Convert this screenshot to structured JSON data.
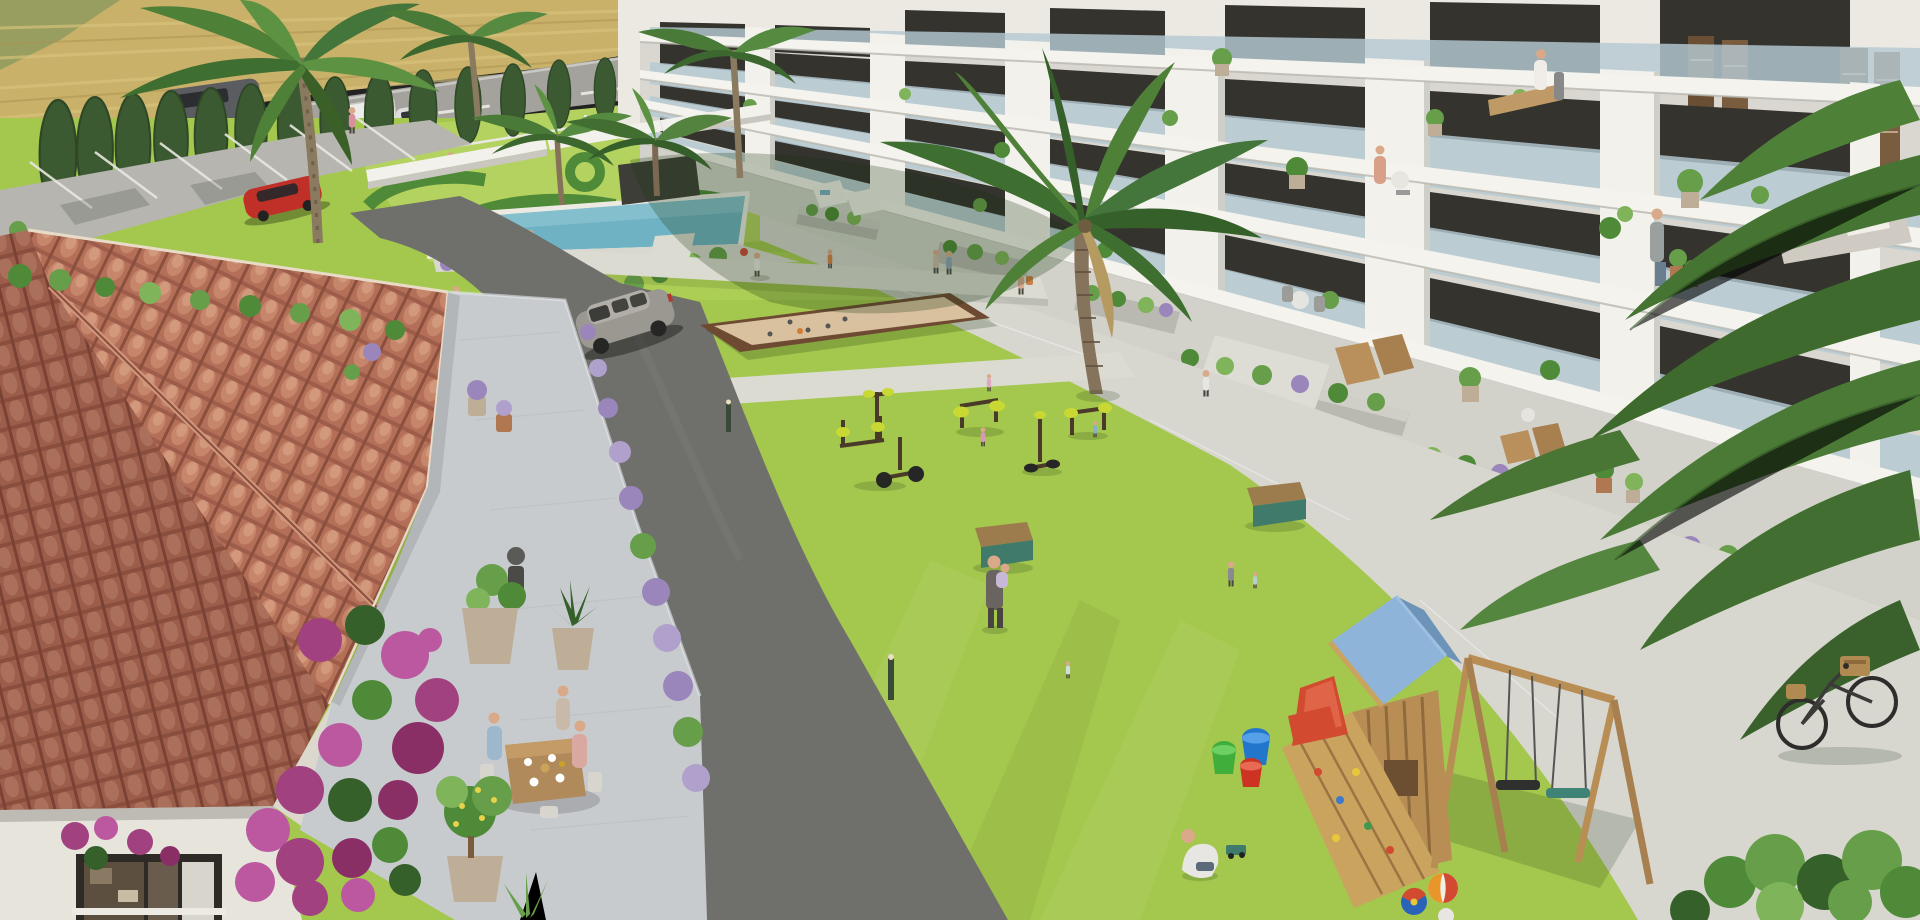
{
  "scene": {
    "title": "Aerial 3D rendering of a Mediterranean residential complex with communal garden courtyard",
    "description": "Daytime high-angle architectural visualization: a modern white apartment block with glass balconies runs diagonally across the upper right; a terracotta tile-roofed clubhouse sits lower left with bougainvillea and an outdoor dining terrace; between them lie lawns with a swimming pool, hedge parterre, petanque court, outdoor gym, children's playground with swing set, paths, an asphalt drive with an SUV, a perimeter road with van and delivery truck beside a wheat field and cypress hedge, and a bicycle parked by ground-floor terraces.",
    "view": "high-angle aerial",
    "style": "photorealistic render",
    "time_of_day": "midday sun from upper left"
  },
  "palette": {
    "wheat": "#c9b169",
    "road": "#a3a29d",
    "parking": "#b6b5b0",
    "lawn": "#a4c74d",
    "lawn_bright": "#b4d25f",
    "hedge": "#4f8a38",
    "asphalt": "#6f6f6b",
    "path": "#d7d6cf",
    "terrace": "#d2d1ca",
    "facade": "#ebe9e2",
    "slab": "#f4f3ee",
    "glass": "#b6c9d3",
    "window": "#34332e",
    "roof_tile": "#b46f58",
    "pool": "#6fb2c4",
    "sand": "#d9c09f",
    "play_roof": "#8fb4da",
    "slide": "#d24a30",
    "cypress": "#3c5a31",
    "palm": "#4f8038",
    "bougainvillea": "#a2417f",
    "lavender": "#9b86bc",
    "wood": "#b98e55"
  },
  "buildings": {
    "apartment_block": {
      "floors_visible": 4,
      "facade": "white concrete",
      "balconies": "glass balustrades with potted plants",
      "windows": "dark framed floor-to-ceiling"
    },
    "clubhouse": {
      "roof": "terracotta barrel tiles, hipped",
      "walls": "white stucco",
      "features": [
        "bougainvillea climber",
        "dark framed window",
        "dining terrace"
      ]
    }
  },
  "amenities": [
    "swimming pool",
    "clipped hedge parterre",
    "petanque court",
    "outdoor gym equipment",
    "children's playground tower",
    "swing set",
    "communal lawns",
    "benches",
    "footpaths",
    "parking bays"
  ],
  "vehicles": [
    {
      "type": "suv",
      "color": "silver",
      "location": "asphalt drive"
    },
    {
      "type": "van",
      "color": "dark grey",
      "location": "perimeter road"
    },
    {
      "type": "box-truck",
      "color": "white with orange logo",
      "location": "perimeter road"
    },
    {
      "type": "car",
      "color": "red",
      "location": "parking bay"
    },
    {
      "type": "bicycle",
      "color": "black with wicker baskets",
      "location": "path by terraces"
    }
  ],
  "vegetation": [
    "wheat field",
    "cypress hedge row",
    "palm trees",
    "bougainvillea",
    "lavender",
    "olive trees in pots",
    "lemon tree in pot",
    "agave",
    "shrub planters"
  ],
  "people": {
    "approx_total": 28,
    "activities": [
      "dining on terrace",
      "walking",
      "children playing",
      "exercising on gym equipment",
      "swimming",
      "balcony work desk",
      "watering balcony plants",
      "carrying a baby",
      "crouching with toy truck"
    ]
  },
  "playground": {
    "tower": "timber with blue gable roof and climbing wall",
    "slide": "red",
    "swings": 2,
    "toys": [
      "green bucket",
      "blue bucket",
      "red bucket",
      "beach balls",
      "toy truck"
    ]
  }
}
